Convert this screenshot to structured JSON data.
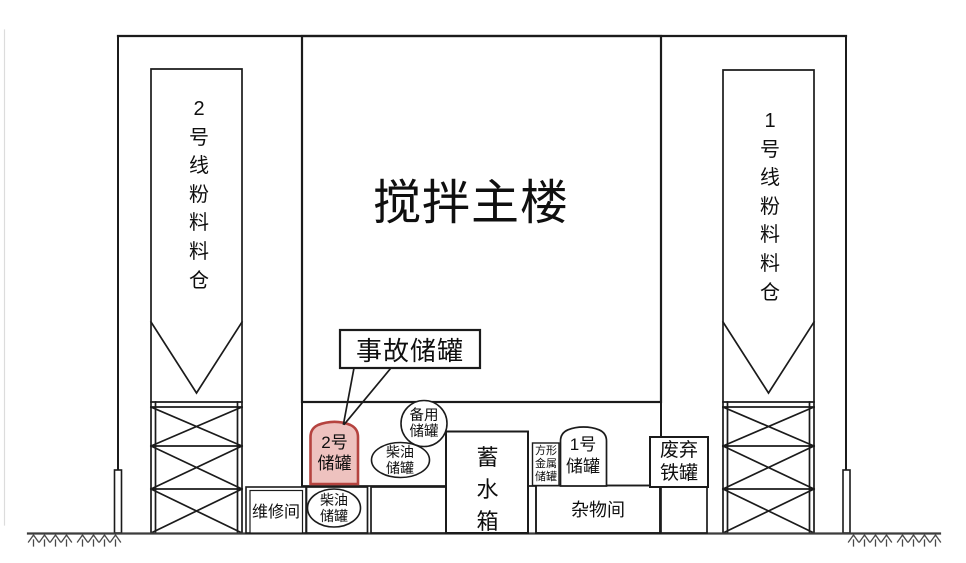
{
  "colors": {
    "line": "#1b1b1b",
    "highlight_fill": "#eec2bf",
    "highlight_stroke": "#b5433f",
    "ground": "#3c3c3c",
    "faint_border": "#dcdcdc"
  },
  "main_building": {
    "label": "搅拌主楼"
  },
  "silos": {
    "left": {
      "label": "2号线粉料料仓"
    },
    "right": {
      "label": "1号线粉料料仓"
    }
  },
  "callout": {
    "label": "事故储罐"
  },
  "tanks": {
    "tank2": {
      "label": "2号\n储罐"
    },
    "diesel_upper": {
      "label": "柴油\n储罐"
    },
    "backup": {
      "label": "备用\n储罐"
    },
    "water": {
      "label": "蓄水箱"
    },
    "square_metal": {
      "label": "方形\n金属\n储罐"
    },
    "tank1": {
      "label": "1号\n储罐"
    },
    "scrap_iron": {
      "label": "废弃\n铁罐"
    },
    "diesel_lower": {
      "label": "柴油\n储罐"
    }
  },
  "rooms": {
    "maintenance": {
      "label": "维修间"
    },
    "sundry": {
      "label": "杂物间"
    }
  }
}
